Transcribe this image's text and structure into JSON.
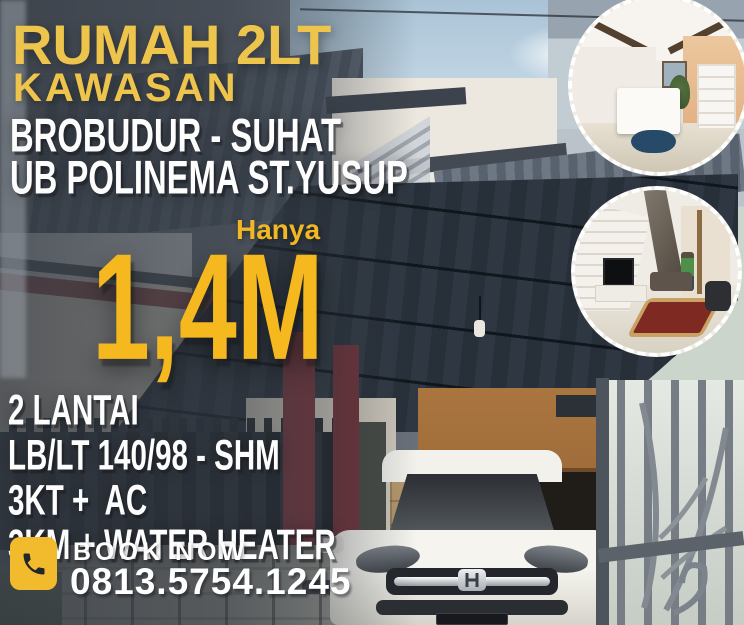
{
  "poster": {
    "title": "RUMAH 2LT",
    "area_label": "KAWASAN",
    "locations": {
      "line1": "BROBUDUR - SUHAT",
      "line2": "UB POLINEMA ST.YUSUP"
    },
    "price": {
      "prefix": "Hanya",
      "value": "1,4M"
    },
    "specs": [
      "2 LANTAI",
      "LB/LT 140/98 - SHM",
      "3KT +  AC",
      "3KM + WATER HEATER"
    ],
    "contact": {
      "cta": "BOOK NOW",
      "phone": "0813.5754.1245",
      "icon": "phone-icon"
    },
    "colors": {
      "gold_title": "#EDC44C",
      "gold_price": "#F5B81E",
      "text_white": "#FFFFFF",
      "phone_box": "#F2BB2E"
    },
    "photos": {
      "main": "two-story-house-exterior-with-carport-and-white-car",
      "inset_top": "interior-living-room-photo",
      "inset_bottom": "interior-tv-room-with-staircase-photo"
    }
  }
}
